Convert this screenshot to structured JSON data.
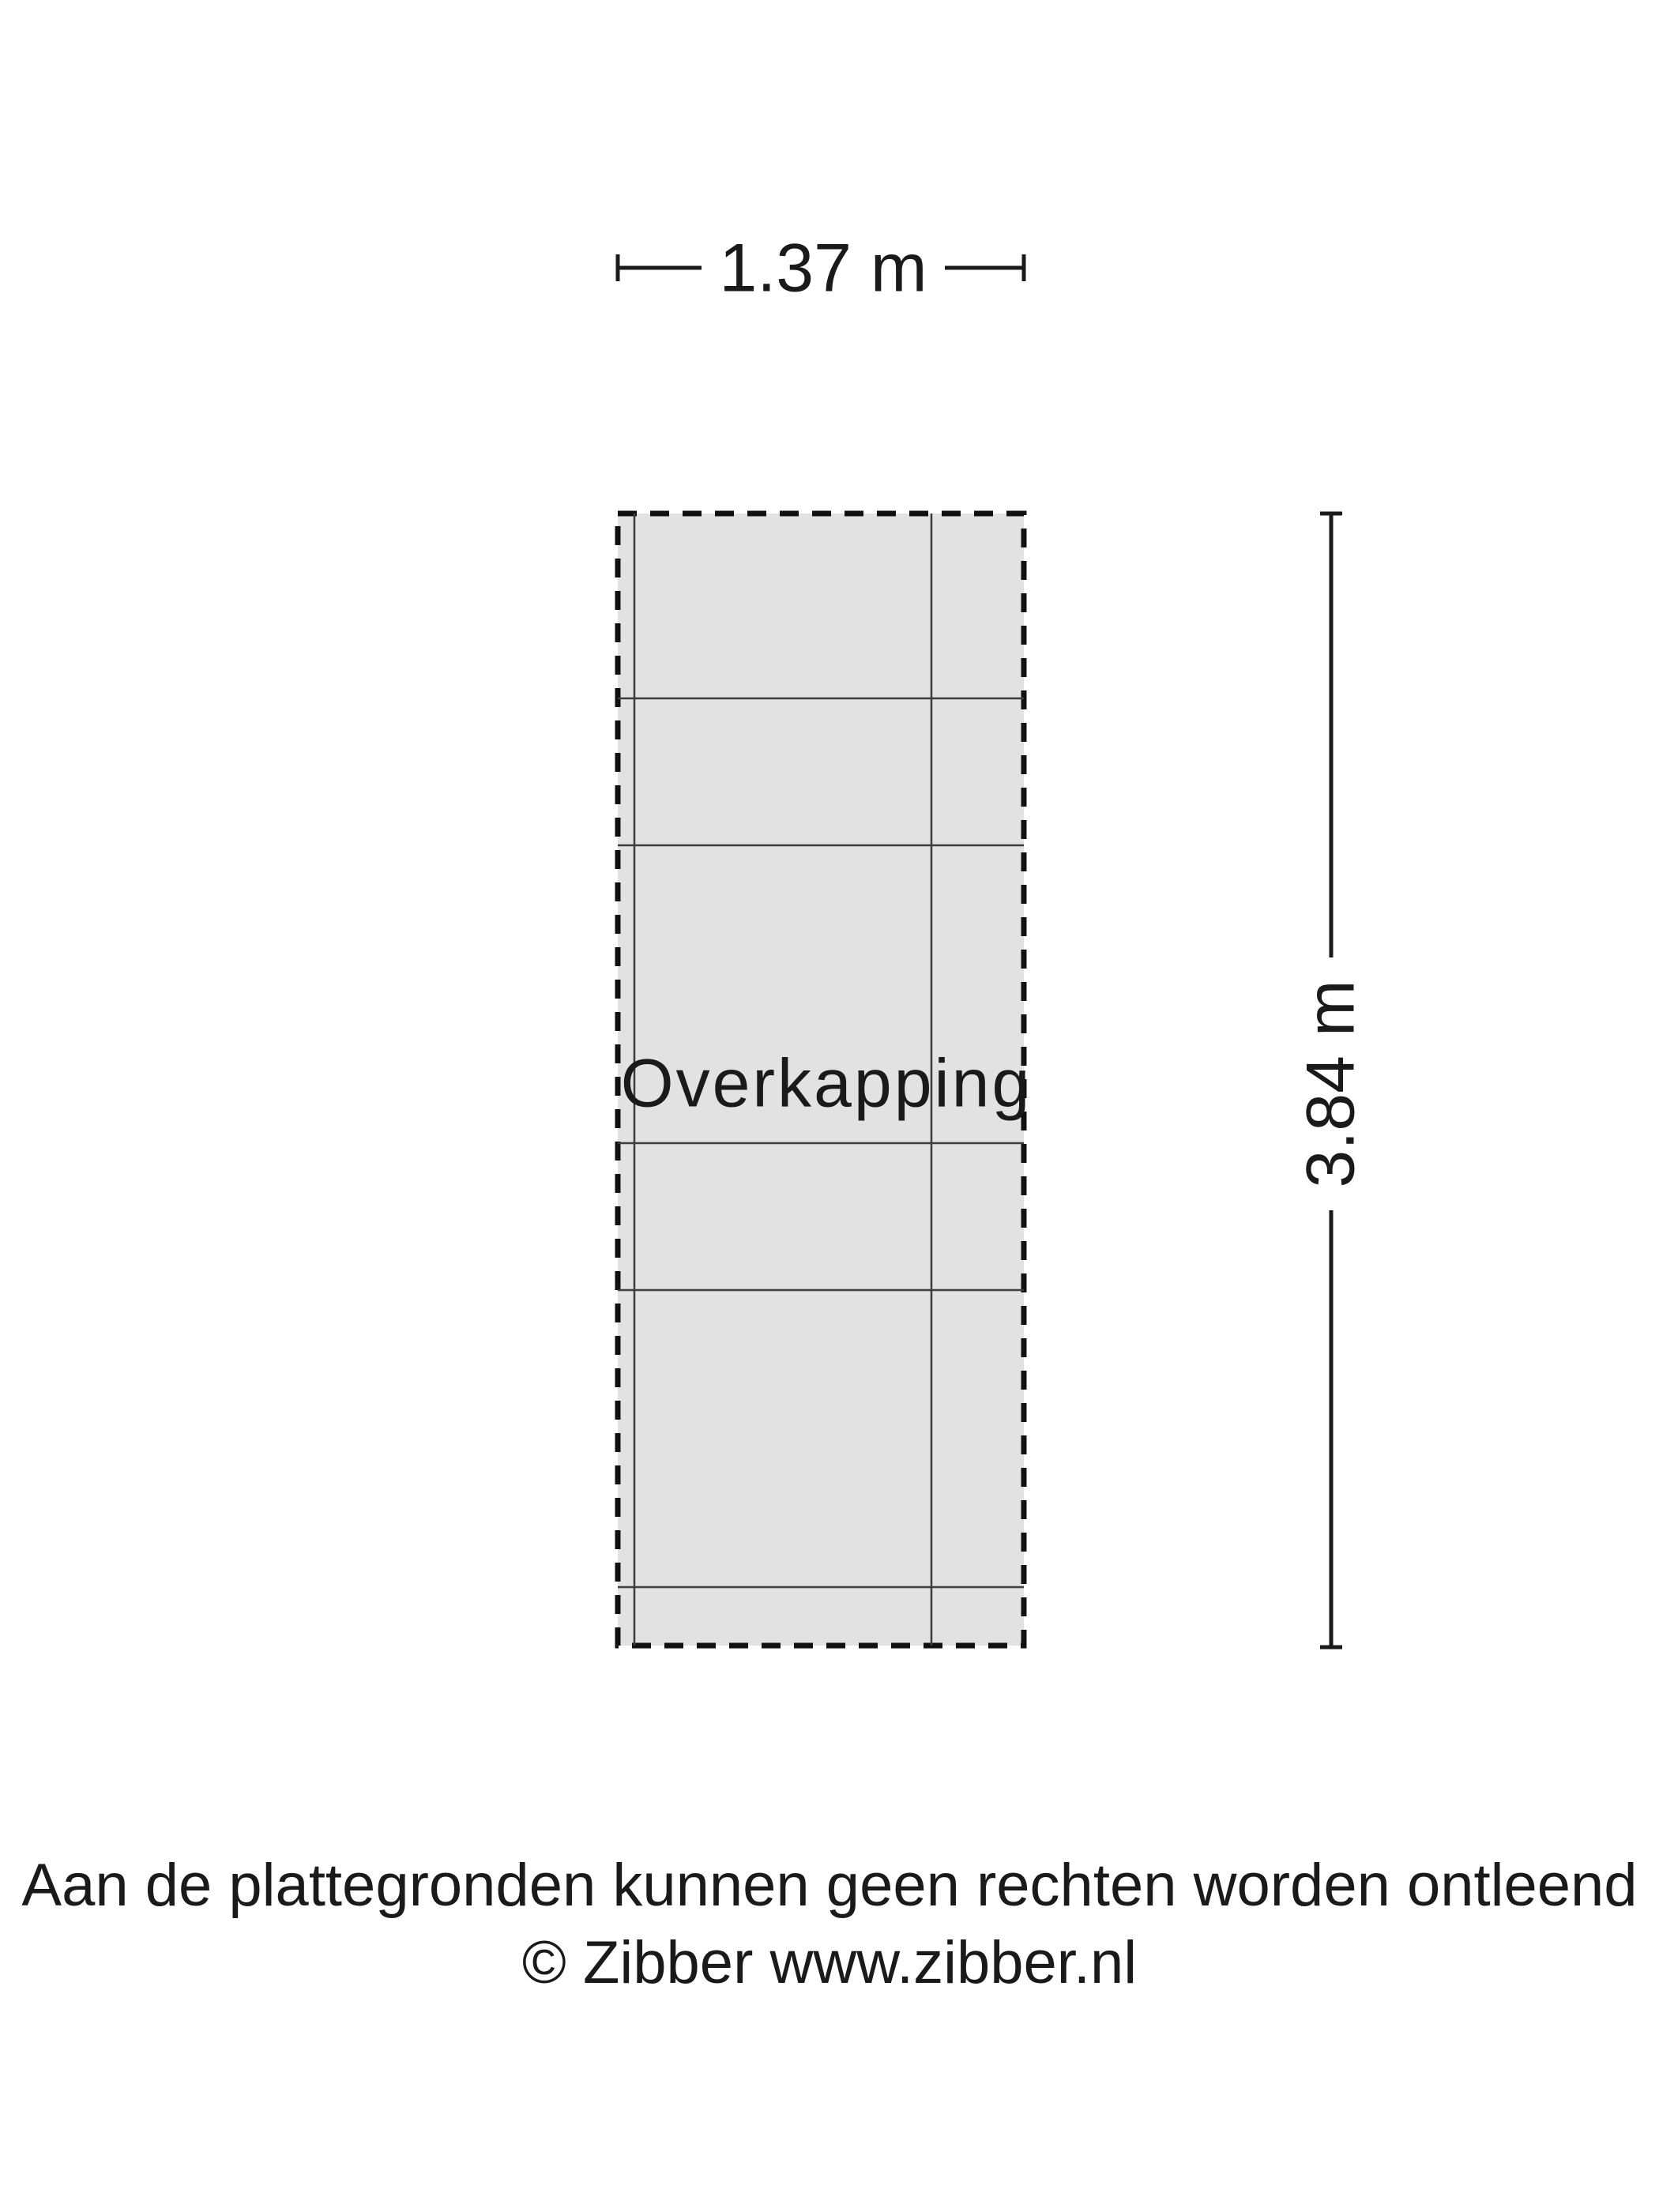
{
  "plan": {
    "room_label": "Overkapping",
    "width_dimension": "1.37 m",
    "height_dimension": "3.84 m",
    "fill_color": "#e2e2e2",
    "border_color": "#111111",
    "grid_line_color": "#3c3c3c",
    "dimension_color": "#1a1a1a"
  },
  "footer": {
    "disclaimer": "Aan de plattegronden kunnen geen rechten worden ontleend",
    "copyright": "© Zibber www.zibber.nl"
  }
}
